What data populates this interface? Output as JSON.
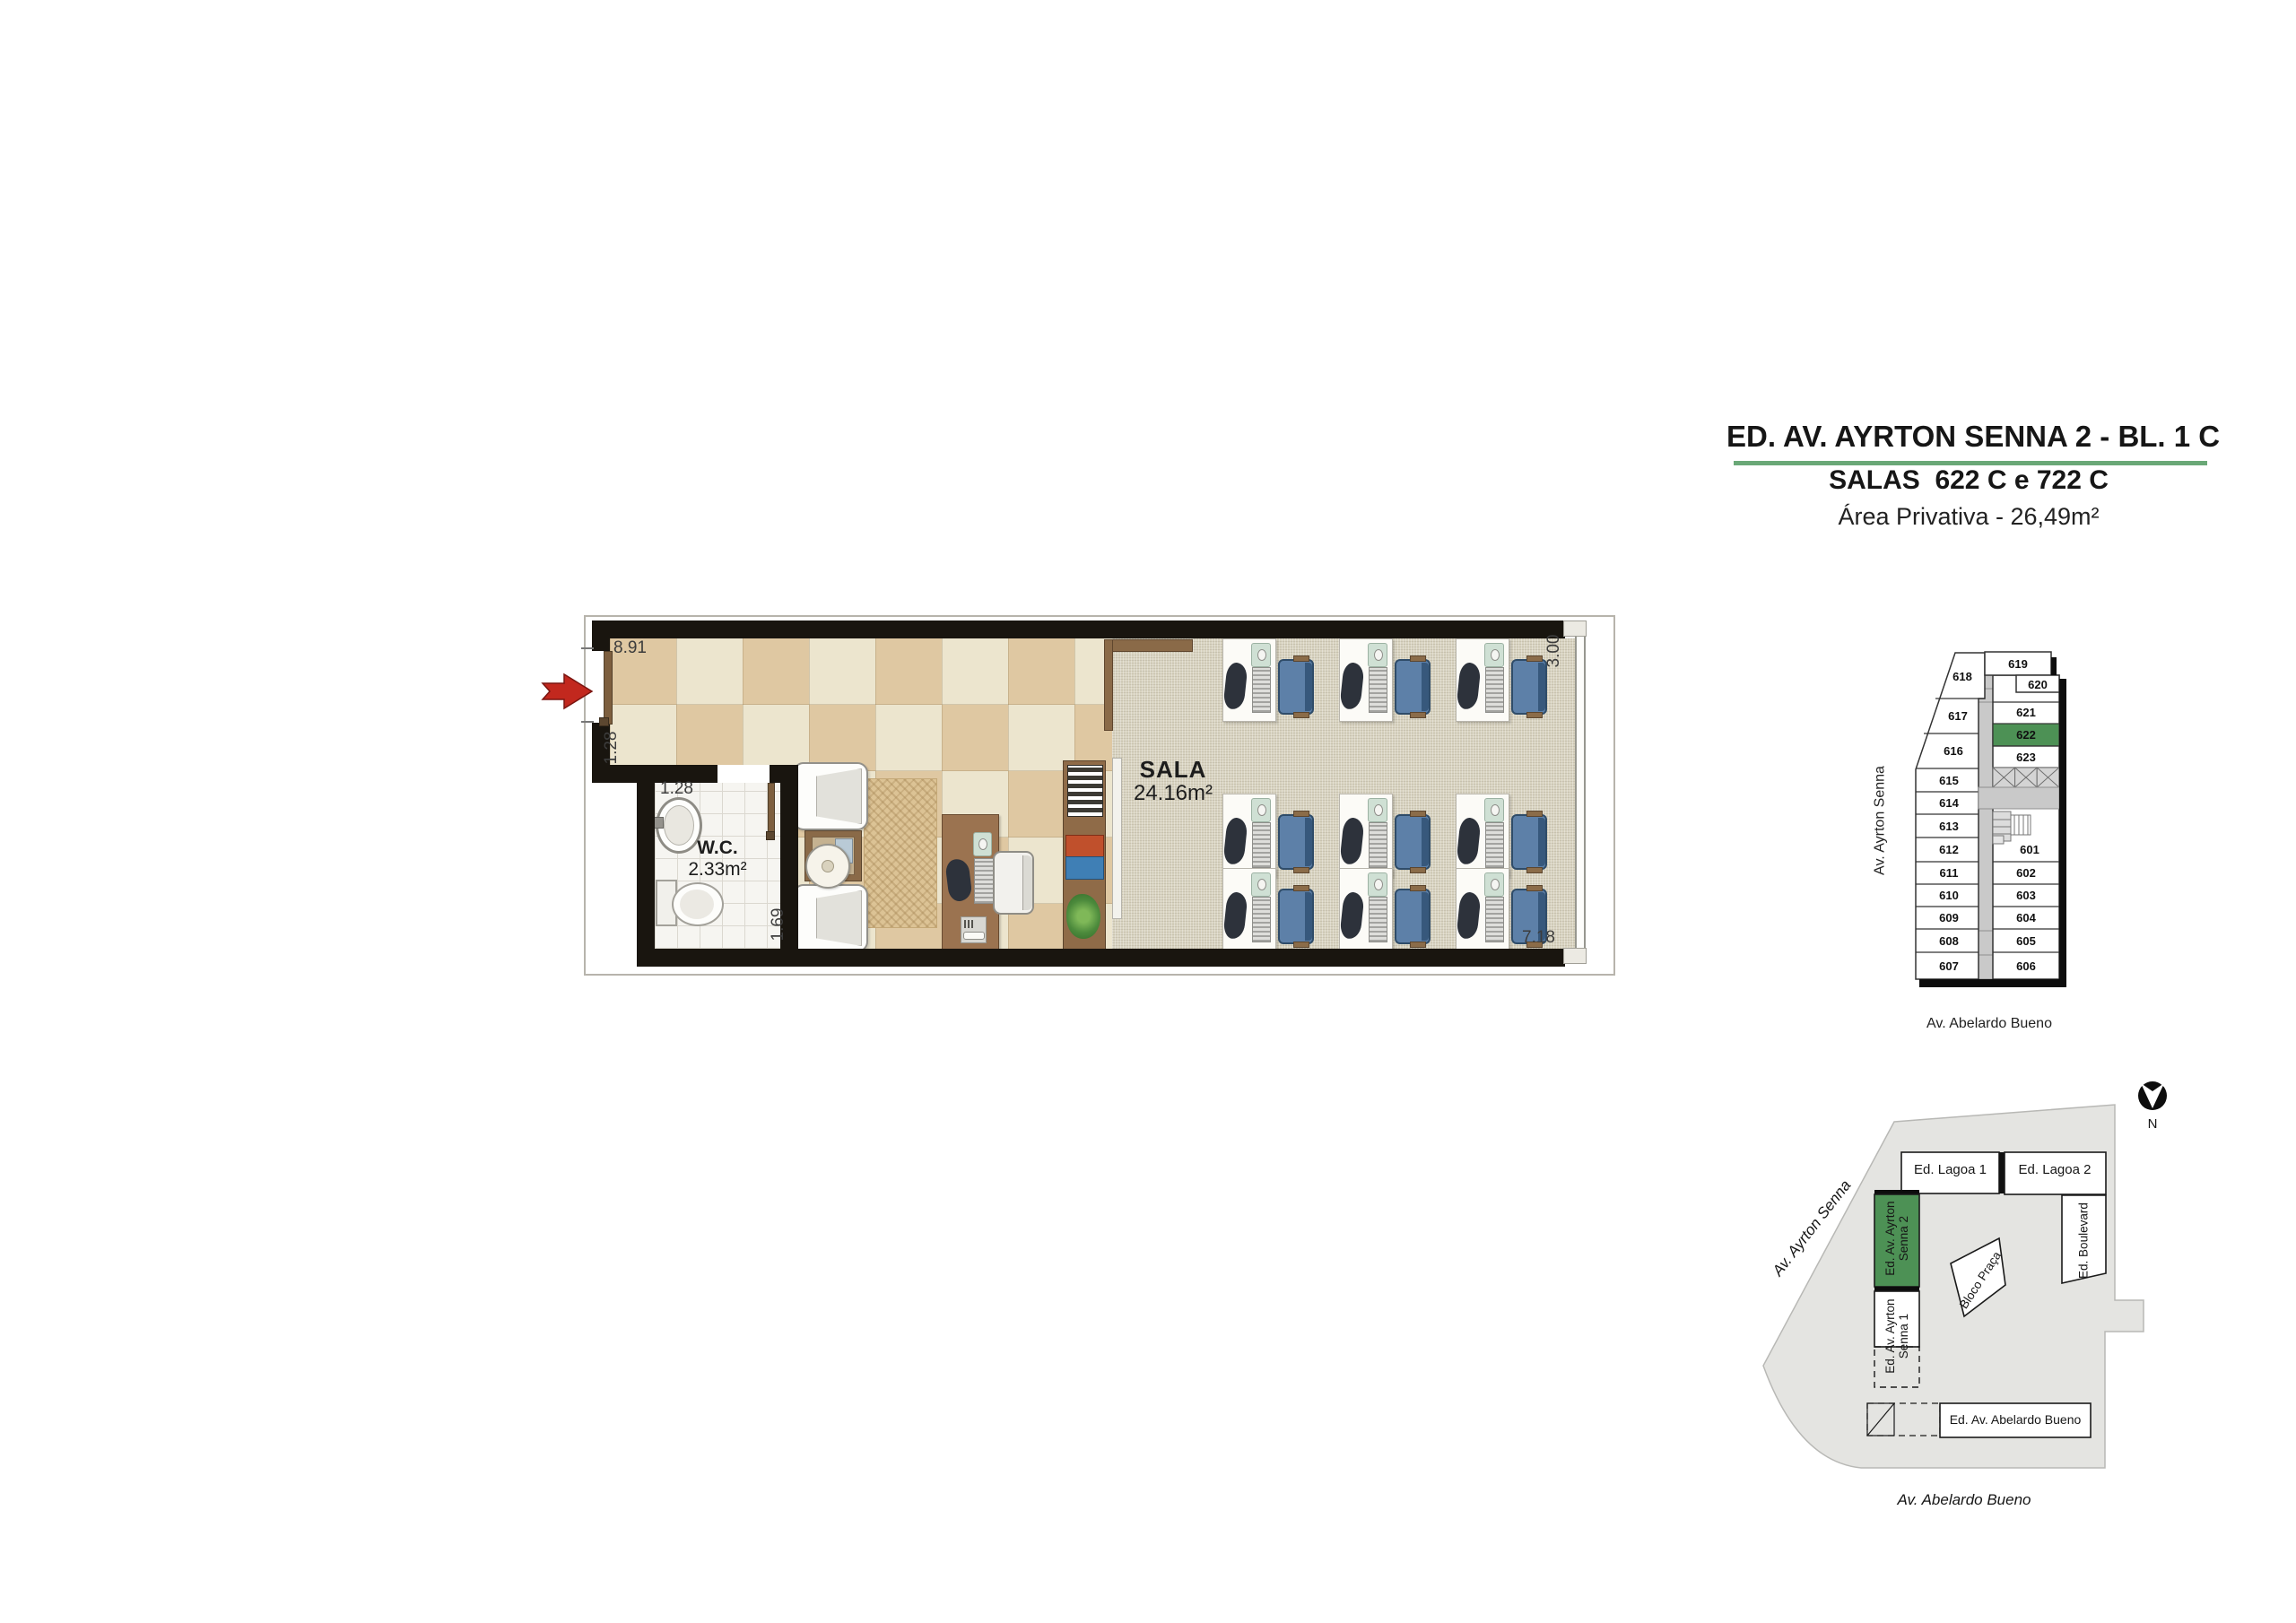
{
  "title": {
    "line1": "ED. AV. AYRTON SENNA 2 - BL. 1 C",
    "line2": "SALAS  622 C e 722 C",
    "line3": "Área Privativa - 26,49m²"
  },
  "colors": {
    "highlight_green": "#4d9155",
    "title_underline": "#6aa877",
    "entry_arrow_red": "#c2281e",
    "workstation_chair_blue": "#5d80a8"
  },
  "floor_plan": {
    "sala": {
      "name": "SALA",
      "area": "24.16m²"
    },
    "wc": {
      "name": "W.C.",
      "area": "2.33m²"
    },
    "dimensions": {
      "top_width": "8.91",
      "entry_side": "1.28",
      "wc_width": "1.28",
      "wc_depth": "1.69",
      "window_width": "3.00",
      "sala_depth": "7.18"
    }
  },
  "key_plan": {
    "street_left": "Av. Ayrton Senna",
    "street_bottom": "Av. Abelardo Bueno",
    "highlighted_unit": "622",
    "left_units": [
      "618",
      "617",
      "616",
      "615",
      "614",
      "613",
      "612",
      "611",
      "610",
      "609",
      "608",
      "607"
    ],
    "right_units": [
      "619",
      "620",
      "621",
      "622",
      "623",
      "601",
      "602",
      "603",
      "604",
      "605",
      "606"
    ]
  },
  "site_plan": {
    "north_label": "N",
    "street_left": "Av. Ayrton Senna",
    "street_bottom": "Av. Abelardo Bueno",
    "buildings": {
      "lagoa1": "Ed. Lagoa 1",
      "lagoa2": "Ed. Lagoa 2",
      "boulevard": "Ed. Boulevard",
      "senna2": "Ed. Av. Ayrton Senna 2",
      "senna1": "Ed. Av. Ayrton Senna 1",
      "bloco": "Bloco Praça",
      "abelardo": "Ed. Av. Abelardo Bueno"
    }
  }
}
